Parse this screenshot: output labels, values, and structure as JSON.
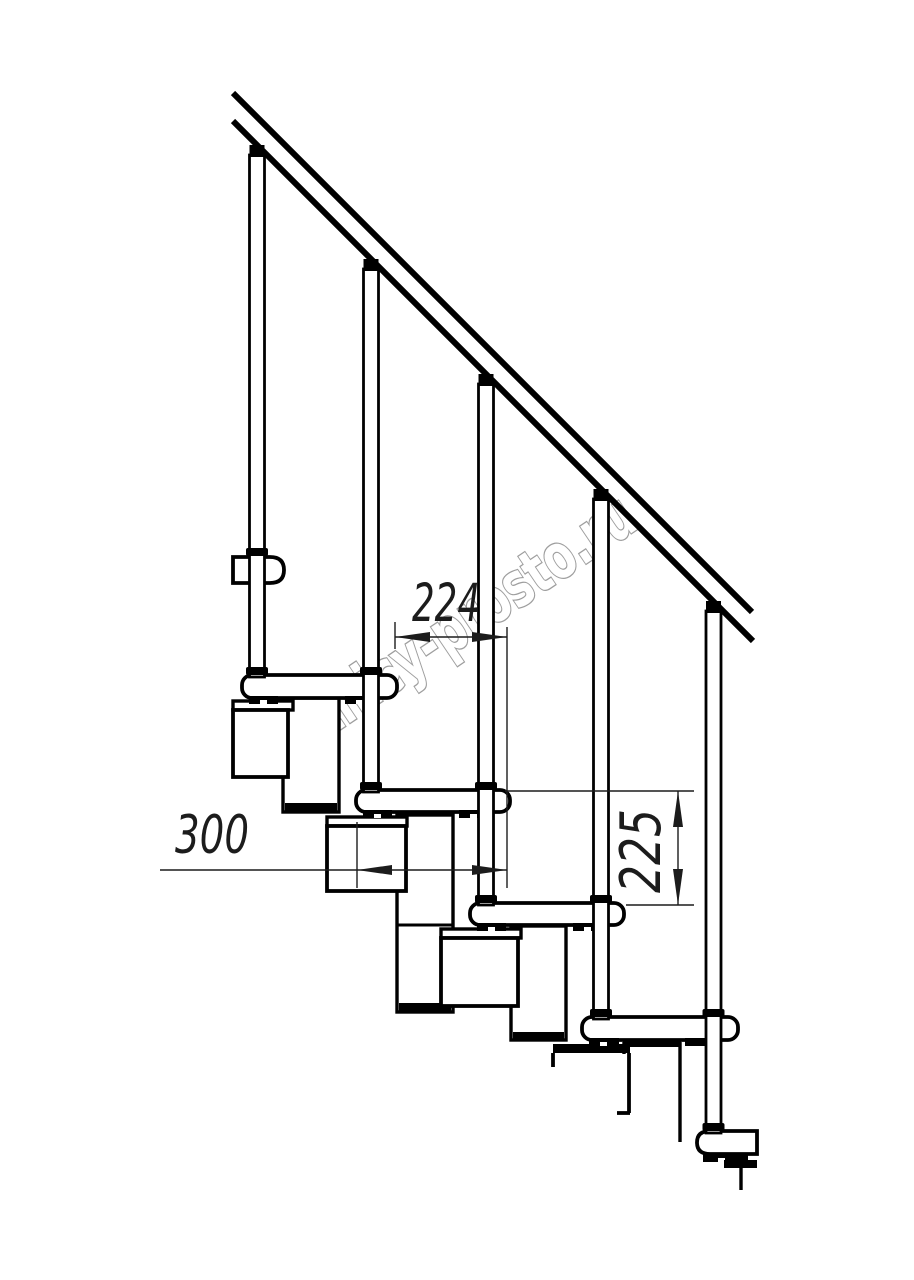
{
  "watermark": {
    "text": "lestnicy-prosto.ru",
    "outline_color": "#9e9e9e"
  },
  "drawing": {
    "background": "#ffffff",
    "ink": "#000000",
    "dimension_ink": "#1c1c1c",
    "dimensions": {
      "run": {
        "value": "224"
      },
      "depth": {
        "value": "300"
      },
      "rise": {
        "value": "225"
      }
    }
  }
}
